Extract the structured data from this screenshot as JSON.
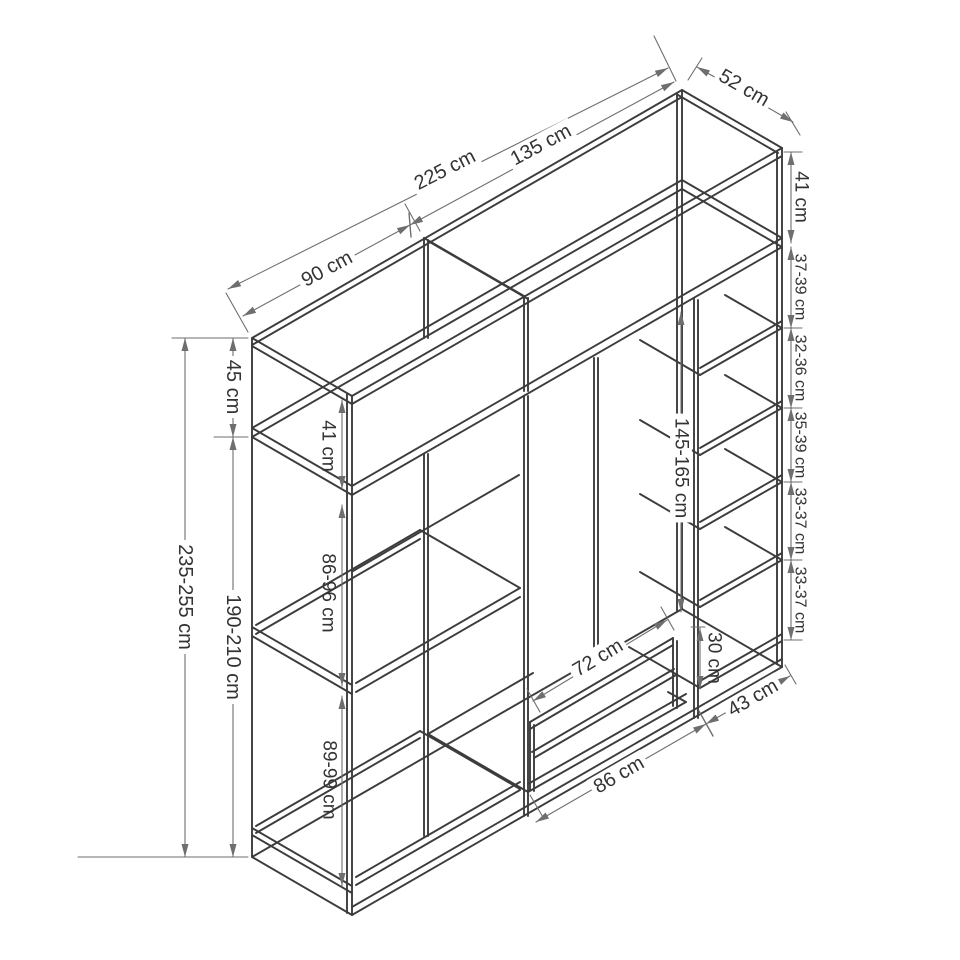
{
  "title": "Wardrobe technical dimension drawing (isometric)",
  "colors": {
    "background": "#ffffff",
    "structure": "#3c3c3c",
    "dimension": "#6e6e6e",
    "text": "#333333",
    "label_bg": "#ffffff"
  },
  "wardrobe": {
    "overall_width": "225 cm",
    "left_section_width": "90 cm",
    "right_section_width": "135 cm",
    "depth": "52 cm",
    "overall_height": "235-255 cm",
    "lower_carcass_height": "190-210 cm",
    "top_section_height": "45 cm",
    "top_left_interior_height": "41 cm",
    "top_right_interior_height": "41 cm",
    "left_column_gaps": [
      "41 cm",
      "86-96 cm",
      "89-99 cm"
    ],
    "middle_section": {
      "hanging_height": "145-165 cm",
      "drawer_width": "72 cm",
      "drawer_height": "30 cm",
      "interior_width": "86 cm"
    },
    "right_column": {
      "width": "43 cm",
      "shelf_gaps_top_to_bottom": [
        "37-39 cm",
        "32-36 cm",
        "35-39 cm",
        "33-37 cm",
        "33-37 cm"
      ]
    }
  },
  "diagram": {
    "canvas": {
      "width": 960,
      "height": 960
    },
    "structure": [
      [
        252,
        338,
        252,
        857
      ],
      [
        252,
        338,
        352,
        396
      ],
      [
        252,
        346,
        352,
        404
      ],
      [
        352,
        396,
        352,
        915
      ],
      [
        347,
        394,
        347,
        913
      ],
      [
        252,
        857,
        352,
        915
      ],
      [
        252,
        338,
        682,
        90
      ],
      [
        252,
        345,
        682,
        97
      ],
      [
        352,
        396,
        782,
        148
      ],
      [
        352,
        404,
        782,
        156
      ],
      [
        682,
        90,
        782,
        148
      ],
      [
        678,
        95,
        778,
        153
      ],
      [
        682,
        90,
        682,
        609
      ],
      [
        677,
        93,
        677,
        611
      ],
      [
        782,
        148,
        782,
        667
      ],
      [
        777,
        151,
        777,
        664
      ],
      [
        252,
        857,
        682,
        609
      ],
      [
        352,
        915,
        782,
        667
      ],
      [
        352,
        907,
        782,
        659
      ],
      [
        682,
        609,
        782,
        667
      ],
      [
        252,
        437,
        352,
        495
      ],
      [
        252,
        428,
        352,
        486
      ],
      [
        252,
        437,
        682,
        189
      ],
      [
        252,
        428,
        682,
        180
      ],
      [
        352,
        495,
        782,
        247
      ],
      [
        352,
        486,
        782,
        238
      ],
      [
        682,
        189,
        782,
        247
      ],
      [
        682,
        180,
        782,
        238
      ],
      [
        424,
        238,
        424,
        338
      ],
      [
        428,
        240,
        428,
        338
      ],
      [
        424,
        238,
        524,
        296
      ],
      [
        428,
        241,
        528,
        299
      ],
      [
        524,
        296,
        524,
        391
      ],
      [
        528,
        298,
        528,
        391
      ],
      [
        424,
        454,
        424,
        836
      ],
      [
        428,
        454,
        428,
        836
      ],
      [
        524,
        396,
        524,
        816
      ],
      [
        528,
        396,
        528,
        816
      ],
      [
        594,
        358,
        594,
        660
      ],
      [
        598,
        358,
        598,
        660
      ],
      [
        694,
        298,
        694,
        718
      ],
      [
        698,
        300,
        698,
        718
      ],
      [
        256,
        634,
        420,
        539
      ],
      [
        256,
        625,
        420,
        530
      ],
      [
        356,
        692,
        520,
        597
      ],
      [
        356,
        683,
        520,
        588
      ],
      [
        252,
        627,
        352,
        685
      ],
      [
        252,
        636,
        352,
        694
      ],
      [
        420,
        530,
        520,
        588
      ],
      [
        256,
        833,
        420,
        738
      ],
      [
        256,
        826,
        420,
        731
      ],
      [
        356,
        885,
        520,
        790
      ],
      [
        356,
        877,
        520,
        782
      ],
      [
        252,
        828,
        352,
        886
      ],
      [
        252,
        835,
        352,
        893
      ],
      [
        420,
        731,
        520,
        789
      ],
      [
        353,
        571,
        519,
        475
      ],
      [
        428,
        734,
        533,
        673
      ],
      [
        528,
        792,
        686,
        702
      ],
      [
        528,
        784,
        686,
        694
      ],
      [
        428,
        734,
        528,
        792
      ],
      [
        668,
        692,
        686,
        702
      ],
      [
        530,
        722,
        673,
        638
      ],
      [
        530,
        729,
        673,
        645
      ],
      [
        532,
        752,
        674,
        669
      ],
      [
        534,
        758,
        676,
        675
      ],
      [
        530,
        722,
        530,
        790
      ],
      [
        534,
        725,
        534,
        791
      ],
      [
        673,
        638,
        673,
        706
      ],
      [
        677,
        641,
        677,
        708
      ],
      [
        700,
        375,
        782,
        328
      ],
      [
        700,
        368,
        782,
        321
      ],
      [
        640,
        340,
        700,
        375
      ],
      [
        725,
        295,
        782,
        328
      ],
      [
        700,
        455,
        782,
        408
      ],
      [
        700,
        448,
        782,
        401
      ],
      [
        640,
        420,
        700,
        455
      ],
      [
        725,
        375,
        782,
        408
      ],
      [
        700,
        529,
        782,
        482
      ],
      [
        700,
        522,
        782,
        475
      ],
      [
        640,
        494,
        700,
        529
      ],
      [
        725,
        449,
        782,
        482
      ],
      [
        700,
        607,
        782,
        560
      ],
      [
        700,
        600,
        782,
        553
      ],
      [
        640,
        572,
        700,
        607
      ],
      [
        725,
        527,
        782,
        560
      ],
      [
        700,
        688,
        782,
        641
      ],
      [
        700,
        681,
        782,
        634
      ],
      [
        629,
        647,
        700,
        688
      ]
    ],
    "witness": [
      [
        248,
        332,
        226,
        293
      ],
      [
        420,
        231,
        405,
        204
      ],
      [
        676,
        81,
        654,
        36
      ],
      [
        688,
        80,
        702,
        58
      ],
      [
        786,
        112,
        800,
        135
      ],
      [
        172,
        338,
        248,
        338
      ],
      [
        78,
        857,
        248,
        857
      ],
      [
        214,
        437,
        248,
        437
      ],
      [
        784,
        152,
        802,
        152
      ],
      [
        784,
        328,
        802,
        328
      ],
      [
        784,
        408,
        802,
        408
      ],
      [
        784,
        482,
        802,
        482
      ],
      [
        784,
        560,
        802,
        560
      ],
      [
        784,
        640,
        802,
        640
      ],
      [
        691,
        627,
        705,
        627
      ],
      [
        527,
        689,
        540,
        712
      ],
      [
        661,
        607,
        674,
        630
      ],
      [
        530,
        795,
        544,
        819
      ],
      [
        785,
        665,
        796,
        684
      ]
    ],
    "ticks": [
      [
        409,
        213,
        411,
        237
      ],
      [
        699,
        711,
        713,
        736
      ]
    ],
    "dims": [
      {
        "x1": 228,
        "y1": 289,
        "x2": 668,
        "y2": 68,
        "label": "225 cm",
        "lx": 445,
        "ly": 170,
        "rot": -27,
        "bg": true,
        "fs": 20
      },
      {
        "x1": 243,
        "y1": 316,
        "x2": 410,
        "y2": 225,
        "label": "90 cm",
        "lx": 327,
        "ly": 269,
        "rot": -28,
        "bg": true,
        "fs": 20
      },
      {
        "x1": 410,
        "y1": 225,
        "x2": 674,
        "y2": 82,
        "label": "135 cm",
        "lx": 541,
        "ly": 145,
        "rot": -28,
        "bg": true,
        "fs": 20
      },
      {
        "x1": 697,
        "y1": 67,
        "x2": 793,
        "y2": 122,
        "label": "52 cm",
        "lx": 744,
        "ly": 88,
        "rot": 30,
        "bg": true,
        "fs": 20
      },
      {
        "x1": 791,
        "y1": 152,
        "x2": 791,
        "y2": 243,
        "label": "41 cm",
        "lx": 801,
        "ly": 197,
        "rot": 90,
        "bg": false,
        "fs": 19
      },
      {
        "x1": 791,
        "y1": 247,
        "x2": 791,
        "y2": 328,
        "label": "37-39 cm",
        "lx": 800,
        "ly": 287,
        "rot": 90,
        "bg": false,
        "fs": 16
      },
      {
        "x1": 791,
        "y1": 328,
        "x2": 791,
        "y2": 408,
        "label": "32-36 cm",
        "lx": 800,
        "ly": 368,
        "rot": 90,
        "bg": false,
        "fs": 16
      },
      {
        "x1": 791,
        "y1": 408,
        "x2": 791,
        "y2": 482,
        "label": "35-39 cm",
        "lx": 800,
        "ly": 445,
        "rot": 90,
        "bg": false,
        "fs": 16
      },
      {
        "x1": 791,
        "y1": 482,
        "x2": 791,
        "y2": 560,
        "label": "33-37 cm",
        "lx": 800,
        "ly": 521,
        "rot": 90,
        "bg": false,
        "fs": 16
      },
      {
        "x1": 791,
        "y1": 560,
        "x2": 791,
        "y2": 640,
        "label": "33-37 cm",
        "lx": 800,
        "ly": 600,
        "rot": 90,
        "bg": false,
        "fs": 16
      },
      {
        "x1": 185,
        "y1": 338,
        "x2": 185,
        "y2": 857,
        "label": "235-255 cm",
        "lx": 185,
        "ly": 597,
        "rot": 90,
        "bg": true,
        "fs": 20
      },
      {
        "x1": 233,
        "y1": 437,
        "x2": 233,
        "y2": 857,
        "label": "190-210 cm",
        "lx": 233,
        "ly": 647,
        "rot": 90,
        "bg": true,
        "fs": 20
      },
      {
        "x1": 233,
        "y1": 338,
        "x2": 233,
        "y2": 437,
        "label": "45 cm",
        "lx": 233,
        "ly": 387,
        "rot": 90,
        "bg": true,
        "fs": 20
      },
      {
        "x1": 342,
        "y1": 400,
        "x2": 342,
        "y2": 489,
        "label": "41 cm",
        "lx": 328,
        "ly": 446,
        "rot": 90,
        "bg": false,
        "fs": 19
      },
      {
        "x1": 342,
        "y1": 505,
        "x2": 342,
        "y2": 686,
        "label": "86-96 cm",
        "lx": 328,
        "ly": 593,
        "rot": 90,
        "bg": false,
        "fs": 19
      },
      {
        "x1": 342,
        "y1": 696,
        "x2": 342,
        "y2": 886,
        "label": "89-99 cm",
        "lx": 329,
        "ly": 780,
        "rot": 90,
        "bg": false,
        "fs": 19
      },
      {
        "x1": 681,
        "y1": 312,
        "x2": 681,
        "y2": 612,
        "label": "145-165 cm",
        "lx": 681,
        "ly": 468,
        "rot": 90,
        "bg": true,
        "fs": 19
      },
      {
        "x1": 700,
        "y1": 628,
        "x2": 700,
        "y2": 689,
        "label": "30 cm",
        "lx": 714,
        "ly": 658,
        "rot": 90,
        "bg": false,
        "fs": 19
      },
      {
        "x1": 533,
        "y1": 701,
        "x2": 667,
        "y2": 620,
        "label": "72 cm",
        "lx": 598,
        "ly": 658,
        "rot": -31,
        "bg": true,
        "fs": 20
      },
      {
        "x1": 536,
        "y1": 822,
        "x2": 706,
        "y2": 724,
        "label": "86 cm",
        "lx": 619,
        "ly": 775,
        "rot": -30,
        "bg": true,
        "fs": 20
      },
      {
        "x1": 706,
        "y1": 724,
        "x2": 790,
        "y2": 676,
        "label": "43 cm",
        "lx": 753,
        "ly": 698,
        "rot": -30,
        "bg": true,
        "fs": 20
      }
    ]
  }
}
